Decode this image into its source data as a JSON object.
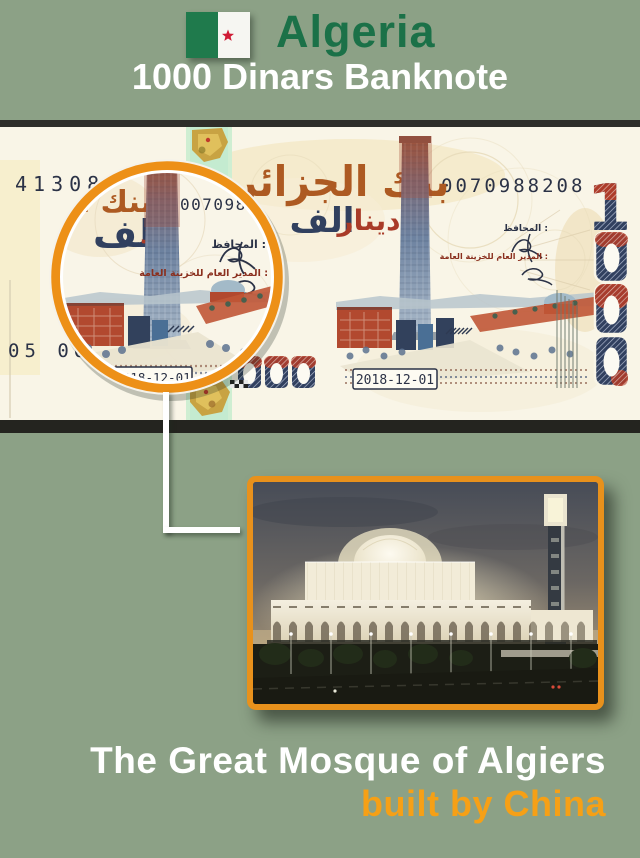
{
  "header": {
    "country": "Algeria",
    "subtitle": "1000 Dinars Banknote"
  },
  "banknote": {
    "serials": {
      "top_left": "41308",
      "top_right": "0070988208",
      "bottom_left": "05 00",
      "magnified": "0070988"
    },
    "arabic": {
      "bank_name": "بنك الجزائر",
      "thousand": "الف",
      "dinar": "دينار",
      "dinar_partial": "د",
      "governor_label": "المحافظ :",
      "director_label": "المدير العام للخزينة العامة :"
    },
    "issue_date": "2018-12-01",
    "digit_one": "1"
  },
  "caption": {
    "line1": "The Great Mosque of Algiers",
    "line2": "built by China"
  },
  "colors": {
    "background": "#8CA186",
    "header_green": "#1B7148",
    "caption_orange": "#F6A016",
    "magnifier_ring_orange": "#ED9017",
    "photo_border_orange": "#E8911C",
    "note_cream": "#F9F5E7",
    "note_navy": "#31405F",
    "note_brick": "#B2492F"
  }
}
